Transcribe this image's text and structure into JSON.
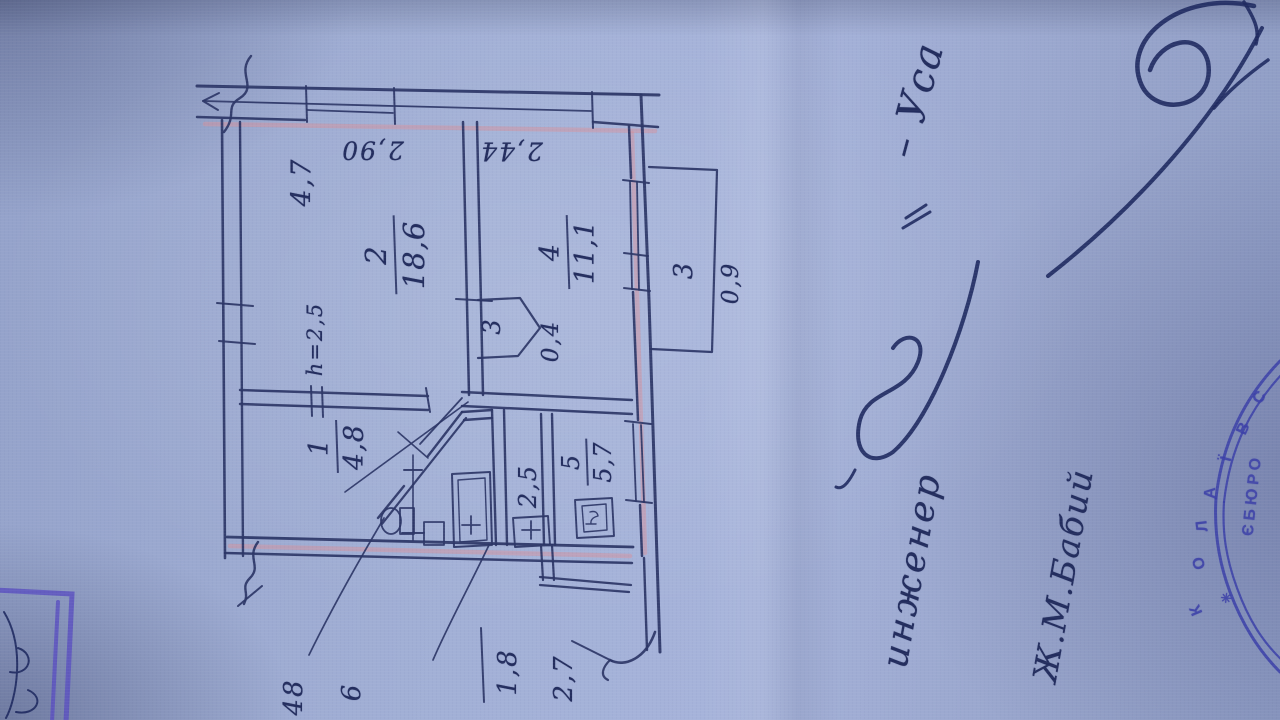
{
  "plan": {
    "rooms": [
      {
        "number": "2",
        "area": "18,6"
      },
      {
        "number": "4",
        "area": "11,1"
      },
      {
        "number": "1",
        "area": "4,8"
      },
      {
        "number": "5",
        "area": "5,7"
      }
    ],
    "closet": {
      "number": "3",
      "area": "0,4"
    },
    "balcony": {
      "number": "3",
      "area": "0,9"
    },
    "height_note": "h=2,5",
    "dimensions": {
      "room2_width": "4,7",
      "room2_length": "2,90",
      "room4_width": "2,44",
      "kitchen_width": "2,5"
    },
    "bottom_labels": {
      "a": "48",
      "b": "6",
      "c": "1,8",
      "d": "2,7"
    }
  },
  "annotations": {
    "engineer_label": "инженер",
    "engineer_name": "– Уса",
    "second_name": "Ж.М.Бабий"
  },
  "stamp": {
    "outer_text": "КОЛАЇВС",
    "inner_text": "ЄБЮРО",
    "star": "✳"
  },
  "colors": {
    "paper": "#9aa8d0",
    "ink": "#2b3566",
    "stamp_blue": "#3b3fa8",
    "corner_stamp_violet": "#5a4fc0",
    "pencil_pink": "#d4919e"
  }
}
